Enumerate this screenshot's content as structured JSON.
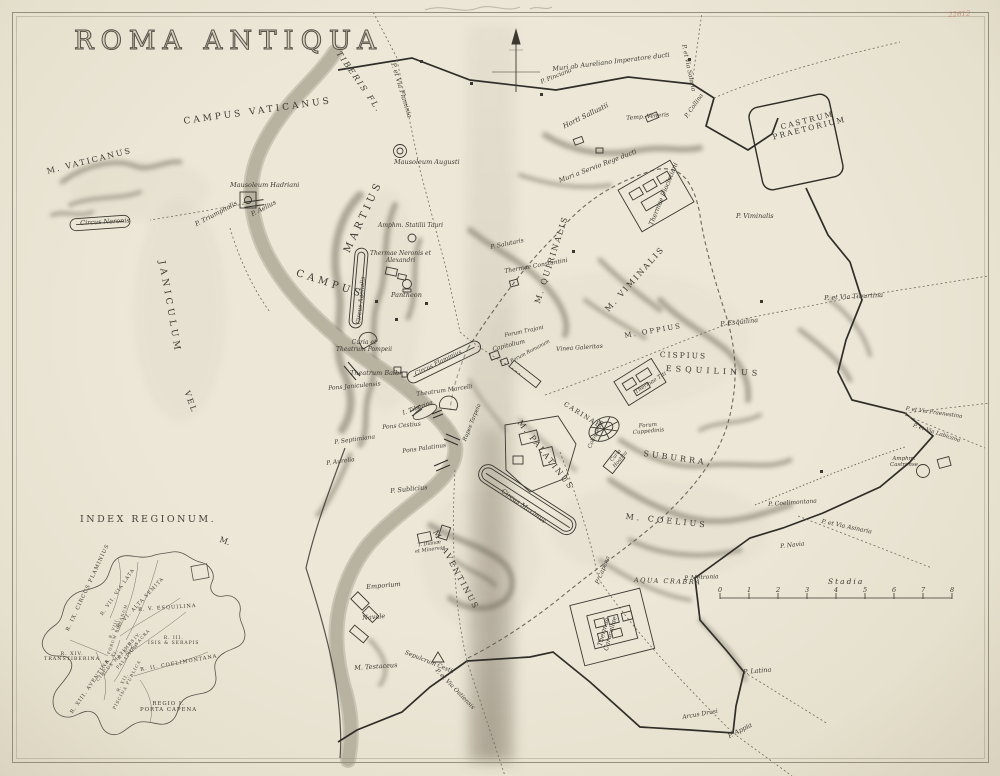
{
  "page": {
    "title": "Roma Antiqua",
    "corner_mark": "22612"
  },
  "scale": {
    "label": "Stadia",
    "ticks": [
      "0",
      "1",
      "2",
      "3",
      "4",
      "5",
      "6",
      "7",
      "8"
    ],
    "x0": 720,
    "x1": 952,
    "y": 598
  },
  "inset": {
    "title": "Index Regionum.",
    "regions": [
      {
        "t": "R. IX. Circus Flaminius",
        "x": 66,
        "y": 630,
        "r": -65,
        "s": 5.2,
        "c": "sp-sm"
      },
      {
        "t": "R. VII. Via Lata",
        "x": 100,
        "y": 614,
        "r": -55,
        "s": 4.8,
        "c": "sp-sm"
      },
      {
        "t": "R. VI. Alta Semita",
        "x": 116,
        "y": 626,
        "r": -47,
        "s": 4.8,
        "c": "sp-sm"
      },
      {
        "t": "R. V. Esquilina",
        "x": 138,
        "y": 608,
        "r": -4,
        "s": 5,
        "c": "sp-sm"
      },
      {
        "t": "R. VIII.\nForum Romanum",
        "x": 103,
        "y": 652,
        "r": -70,
        "s": 3.8,
        "c": "sp-sm two"
      },
      {
        "t": "R. IV.\nVia Sacra",
        "x": 122,
        "y": 650,
        "r": -48,
        "s": 4.2,
        "c": "sp-sm two"
      },
      {
        "t": "R. III.\nIsis & Serapis",
        "x": 148,
        "y": 636,
        "r": 0,
        "s": 4.5,
        "c": "sp-sm two"
      },
      {
        "t": "R. X.\nPalatium",
        "x": 112,
        "y": 664,
        "r": -50,
        "s": 4.2,
        "c": "sp-sm two"
      },
      {
        "t": "R. XI.\nCircus Maximus",
        "x": 92,
        "y": 676,
        "r": -48,
        "s": 4.2,
        "c": "sp-sm two"
      },
      {
        "t": "R. II. Coelimontana",
        "x": 140,
        "y": 668,
        "r": -10,
        "s": 5,
        "c": "sp-sm"
      },
      {
        "t": "R. XIV.\nTranstiberina",
        "x": 44,
        "y": 652,
        "r": 0,
        "s": 4.8,
        "c": "sp-sm two"
      },
      {
        "t": "R. XIII. Aventina",
        "x": 70,
        "y": 712,
        "r": -55,
        "s": 5,
        "c": "sp-sm"
      },
      {
        "t": "R. XII.\nPiscina Publica",
        "x": 108,
        "y": 706,
        "r": -62,
        "s": 4.2,
        "c": "sp-sm two"
      },
      {
        "t": "Regio I.\nPorta Capena",
        "x": 140,
        "y": 701,
        "r": 0,
        "s": 5.4,
        "c": "sp-sm two"
      }
    ]
  },
  "labels": [
    {
      "t": "Campus Vaticanus",
      "x": 183,
      "y": 117,
      "r": -8,
      "s": 9,
      "c": "sp",
      "ls": 3
    },
    {
      "t": "M. Vaticanus",
      "x": 46,
      "y": 168,
      "r": -14,
      "s": 8,
      "c": "sp",
      "ls": 2
    },
    {
      "t": "Circus Neronis",
      "x": 80,
      "y": 220,
      "r": -3,
      "s": 6.5,
      "c": "it"
    },
    {
      "t": "Mausoleum Hadriani",
      "x": 230,
      "y": 182,
      "r": 0,
      "s": 6.5,
      "c": "it"
    },
    {
      "t": "P. Aelius",
      "x": 250,
      "y": 212,
      "r": -28,
      "s": 6.5,
      "c": "it"
    },
    {
      "t": "P. Triumphalis",
      "x": 194,
      "y": 222,
      "r": -28,
      "s": 6.5,
      "c": "it"
    },
    {
      "t": "Tiberis Fl.",
      "x": 341,
      "y": 50,
      "r": 55,
      "s": 8,
      "c": "sp it",
      "ls": 2
    },
    {
      "t": "P. et Via Flaminia",
      "x": 396,
      "y": 62,
      "r": 73,
      "s": 6.5,
      "c": "it"
    },
    {
      "t": "Mausoleum Augusti",
      "x": 394,
      "y": 159,
      "r": 0,
      "s": 6.5,
      "c": "it"
    },
    {
      "t": "Muri ab Aureliano Imperatore ducti",
      "x": 552,
      "y": 66,
      "r": -7,
      "s": 6.5,
      "c": "it"
    },
    {
      "t": "P. et Via Salaria",
      "x": 686,
      "y": 44,
      "r": 78,
      "s": 6,
      "c": "it"
    },
    {
      "t": "P. Pinciana",
      "x": 540,
      "y": 80,
      "r": -22,
      "s": 6,
      "c": "it"
    },
    {
      "t": "Horti Sallustii",
      "x": 562,
      "y": 124,
      "r": -26,
      "s": 7,
      "c": "it"
    },
    {
      "t": "Temp. Veneris",
      "x": 626,
      "y": 116,
      "r": -5,
      "s": 6,
      "c": "it"
    },
    {
      "t": "P. Collina",
      "x": 684,
      "y": 116,
      "r": -55,
      "s": 6,
      "c": "it"
    },
    {
      "t": "Castrum\nPraetorium",
      "x": 770,
      "y": 126,
      "r": -14,
      "s": 7.5,
      "c": "sp two",
      "ls": 2
    },
    {
      "t": "Muri a Servio Rege ducti",
      "x": 558,
      "y": 178,
      "r": -21,
      "s": 6.5,
      "c": "it"
    },
    {
      "t": "Thermae Diocletiani",
      "x": 648,
      "y": 224,
      "r": -68,
      "s": 6.5,
      "c": "it"
    },
    {
      "t": "P. Viminalis",
      "x": 736,
      "y": 213,
      "r": 0,
      "s": 6.5,
      "c": "it"
    },
    {
      "t": "M. Quirinalis",
      "x": 534,
      "y": 302,
      "r": -72,
      "s": 8,
      "c": "sp",
      "ls": 2
    },
    {
      "t": "M. Viminalis",
      "x": 604,
      "y": 308,
      "r": -48,
      "s": 8,
      "c": "sp",
      "ls": 2
    },
    {
      "t": "P. Salutaris",
      "x": 490,
      "y": 245,
      "r": -12,
      "s": 6,
      "c": "it"
    },
    {
      "t": "Thermae Constantini",
      "x": 504,
      "y": 269,
      "r": -10,
      "s": 6,
      "c": "it"
    },
    {
      "t": "Campus",
      "x": 298,
      "y": 268,
      "r": 18,
      "s": 10,
      "c": "sp",
      "ls": 4
    },
    {
      "t": "Martius",
      "x": 342,
      "y": 250,
      "r": -65,
      "s": 10,
      "c": "sp",
      "ls": 4
    },
    {
      "t": "Thermae Neronis et\nAlexandri",
      "x": 370,
      "y": 251,
      "r": 0,
      "s": 6,
      "c": "it two"
    },
    {
      "t": "Pantheon",
      "x": 391,
      "y": 292,
      "r": 0,
      "s": 6.5,
      "c": "it"
    },
    {
      "t": "Circus Agonalis",
      "x": 356,
      "y": 324,
      "r": -84,
      "s": 6,
      "c": "it"
    },
    {
      "t": "Amphm. Statilii Tauri",
      "x": 378,
      "y": 223,
      "r": 0,
      "s": 6,
      "c": "it"
    },
    {
      "t": "Curia et\nTheatrum Pompeii",
      "x": 336,
      "y": 340,
      "r": 0,
      "s": 6,
      "c": "it two"
    },
    {
      "t": "Theatrum Balbi",
      "x": 350,
      "y": 370,
      "r": 0,
      "s": 6.5,
      "c": "it"
    },
    {
      "t": "Pons Janiculensis",
      "x": 328,
      "y": 386,
      "r": -5,
      "s": 6,
      "c": "it"
    },
    {
      "t": "Circus Flaminius",
      "x": 414,
      "y": 372,
      "r": -26,
      "s": 6,
      "c": "it"
    },
    {
      "t": "Theatrum Marcelli",
      "x": 416,
      "y": 392,
      "r": -8,
      "s": 6,
      "c": "it"
    },
    {
      "t": "I. Tiberina",
      "x": 402,
      "y": 411,
      "r": -20,
      "s": 6,
      "c": "it"
    },
    {
      "t": "Pons Cestius",
      "x": 382,
      "y": 425,
      "r": -5,
      "s": 6,
      "c": "it"
    },
    {
      "t": "Pons Palatinus",
      "x": 402,
      "y": 449,
      "r": -8,
      "s": 6,
      "c": "it"
    },
    {
      "t": "Rupes Tarpeia",
      "x": 462,
      "y": 440,
      "r": -68,
      "s": 5.5,
      "c": "it"
    },
    {
      "t": "P. Septimiana",
      "x": 334,
      "y": 440,
      "r": -8,
      "s": 6,
      "c": "it"
    },
    {
      "t": "P. Aurelia",
      "x": 326,
      "y": 461,
      "r": -8,
      "s": 6,
      "c": "it"
    },
    {
      "t": "P. Sublicius",
      "x": 390,
      "y": 488,
      "r": -6,
      "s": 6.5,
      "c": "it"
    },
    {
      "t": "Janiculum",
      "x": 166,
      "y": 260,
      "r": 80,
      "s": 9,
      "c": "sp",
      "ls": 4
    },
    {
      "t": "vel",
      "x": 190,
      "y": 390,
      "r": 70,
      "s": 8,
      "c": "sp",
      "ls": 2
    },
    {
      "t": "M.",
      "x": 221,
      "y": 536,
      "r": 20,
      "s": 8,
      "c": "sp"
    },
    {
      "t": "Forum Trajani",
      "x": 504,
      "y": 333,
      "r": -12,
      "s": 5.5,
      "c": "it"
    },
    {
      "t": "Capitolium",
      "x": 492,
      "y": 347,
      "r": -14,
      "s": 6,
      "c": "it"
    },
    {
      "t": "Forum Romanum",
      "x": 510,
      "y": 360,
      "r": -28,
      "s": 5,
      "c": "it"
    },
    {
      "t": "Vinea Galeritas",
      "x": 556,
      "y": 347,
      "r": -4,
      "s": 6,
      "c": "it"
    },
    {
      "t": "M. Oppius",
      "x": 624,
      "y": 333,
      "r": -10,
      "s": 7,
      "c": "sp",
      "ls": 2
    },
    {
      "t": "Cispius",
      "x": 660,
      "y": 351,
      "r": 2,
      "s": 7.5,
      "c": "sp",
      "ls": 2
    },
    {
      "t": "Esquilinus",
      "x": 666,
      "y": 365,
      "r": 3,
      "s": 8,
      "c": "sp",
      "ls": 4
    },
    {
      "t": "Thermae Titi",
      "x": 634,
      "y": 390,
      "r": -32,
      "s": 5.5,
      "c": "it"
    },
    {
      "t": "Carinae",
      "x": 566,
      "y": 401,
      "r": 32,
      "s": 6.5,
      "c": "sp",
      "ls": 1.5
    },
    {
      "t": "Colosseum",
      "x": 587,
      "y": 447,
      "r": -65,
      "s": 5.5,
      "c": "it"
    },
    {
      "t": "Forum\nCuppedinis",
      "x": 632,
      "y": 424,
      "r": -5,
      "s": 5.5,
      "c": "it two"
    },
    {
      "t": "Suburra",
      "x": 644,
      "y": 450,
      "r": 8,
      "s": 8,
      "c": "sp",
      "ls": 3
    },
    {
      "t": "Curia\nHostilia",
      "x": 608,
      "y": 462,
      "r": -50,
      "s": 5,
      "c": "it two"
    },
    {
      "t": "M. Palatinus",
      "x": 522,
      "y": 419,
      "r": 52,
      "s": 8,
      "c": "sp",
      "ls": 2
    },
    {
      "t": "Circus Maximus",
      "x": 504,
      "y": 488,
      "r": 36,
      "s": 6.5,
      "c": "it"
    },
    {
      "t": "M. Coelius",
      "x": 626,
      "y": 513,
      "r": 6,
      "s": 8,
      "c": "sp",
      "ls": 3
    },
    {
      "t": "P. Capena",
      "x": 595,
      "y": 583,
      "r": -68,
      "s": 6,
      "c": "it"
    },
    {
      "t": "M. Aventinus",
      "x": 438,
      "y": 529,
      "r": 62,
      "s": 8,
      "c": "sp",
      "ls": 2
    },
    {
      "t": "T. Dianae\net Minervae",
      "x": 414,
      "y": 544,
      "r": -8,
      "s": 5,
      "c": "it two"
    },
    {
      "t": "Emporium",
      "x": 366,
      "y": 584,
      "r": -5,
      "s": 6.5,
      "c": "it"
    },
    {
      "t": "Navale",
      "x": 362,
      "y": 615,
      "r": -5,
      "s": 6.5,
      "c": "it"
    },
    {
      "t": "Sepulcrum Cestii",
      "x": 406,
      "y": 650,
      "r": 22,
      "s": 6,
      "c": "it"
    },
    {
      "t": "M. Testaceus",
      "x": 354,
      "y": 665,
      "r": -4,
      "s": 6.5,
      "c": "it"
    },
    {
      "t": "P. et Via Ostiensis",
      "x": 438,
      "y": 668,
      "r": 46,
      "s": 6,
      "c": "it"
    },
    {
      "t": "Aqua Crabra",
      "x": 634,
      "y": 577,
      "r": 2,
      "s": 6.5,
      "c": "sp it",
      "ls": 1.5
    },
    {
      "t": "P. Metronia",
      "x": 684,
      "y": 576,
      "r": -3,
      "s": 6,
      "c": "it"
    },
    {
      "t": "Thermae\nCaracallae",
      "x": 596,
      "y": 648,
      "r": -75,
      "s": 6.5,
      "c": "it two"
    },
    {
      "t": "P. Latina",
      "x": 743,
      "y": 669,
      "r": -5,
      "s": 6.5,
      "c": "it"
    },
    {
      "t": "Arcus Drusi",
      "x": 682,
      "y": 715,
      "r": -10,
      "s": 6,
      "c": "it"
    },
    {
      "t": "P. Appia",
      "x": 727,
      "y": 734,
      "r": -28,
      "s": 6.5,
      "c": "it"
    },
    {
      "t": "P. Coelimontana",
      "x": 768,
      "y": 502,
      "r": -4,
      "s": 6,
      "c": "it"
    },
    {
      "t": "P. Navia",
      "x": 780,
      "y": 544,
      "r": -6,
      "s": 6,
      "c": "it"
    },
    {
      "t": "P. et Via Asinaria",
      "x": 822,
      "y": 519,
      "r": 12,
      "s": 6,
      "c": "it"
    },
    {
      "t": "Amphm.\nCastrense",
      "x": 890,
      "y": 456,
      "r": 0,
      "s": 5.5,
      "c": "it two"
    },
    {
      "t": "P. et Via Praenestina",
      "x": 906,
      "y": 406,
      "r": 8,
      "s": 5.5,
      "c": "it"
    },
    {
      "t": "P. et Via Labicana",
      "x": 914,
      "y": 423,
      "r": 18,
      "s": 5.5,
      "c": "it"
    },
    {
      "t": "P. et Via Tiburtina",
      "x": 824,
      "y": 295,
      "r": -3,
      "s": 6.5,
      "c": "it"
    },
    {
      "t": "P. Esquilina",
      "x": 720,
      "y": 321,
      "r": -6,
      "s": 6.5,
      "c": "it"
    }
  ]
}
